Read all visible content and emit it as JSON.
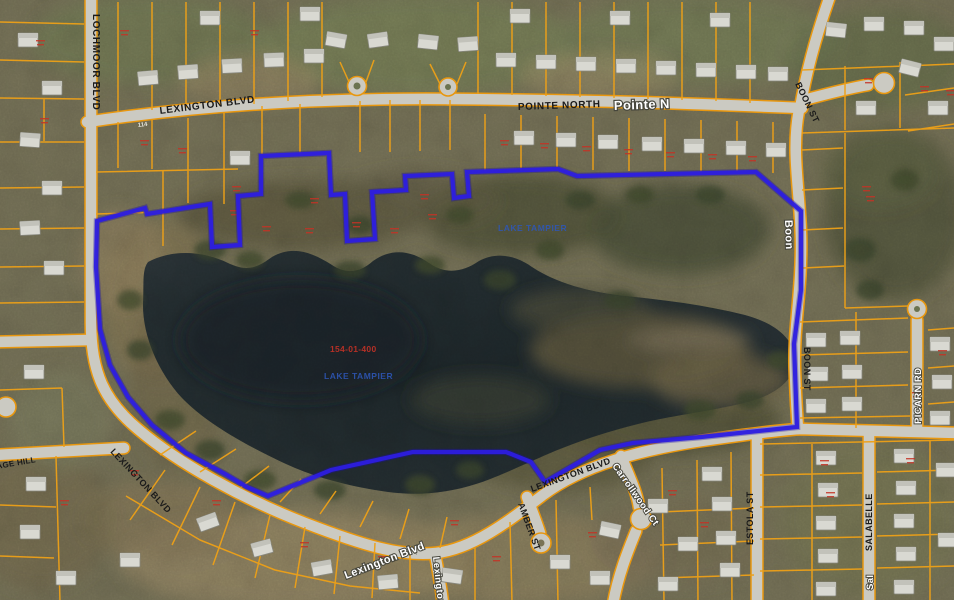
{
  "map": {
    "description": "Aerial photo parcel viewer with lake parcel selected in blue",
    "streets": {
      "lochmoor": "LOCHMOOR BLVD",
      "lexington_top": "LEXINGTON BLVD",
      "pointe_north": "POINTE NORTH",
      "pointe_n_road": "Pointe N",
      "boon_top": "BOON ST",
      "boon_road": "Boon",
      "boon_mid": "BOON ST",
      "picarn_road": "PICARN RD",
      "lexington_sw": "LEXINGTON BLVD",
      "age_hill": "AGE HILL",
      "lexington_road": "Lexington Blvd",
      "lexington_road_vert": "Lexington",
      "amber": "AMBER ST",
      "carrollwood_road": "Carrollwood Ct",
      "lexington_se": "LEXINGTON BLVD",
      "estola": "ESTOLA ST",
      "salabelle": "SALABELLE",
      "salabelle_road": "Sal"
    },
    "road_marker": "114",
    "water": {
      "label_upper": "LAKE TAMPIER",
      "label_lower": "LAKE TAMPIER"
    },
    "selected_parcel": {
      "id_label": "154-01-400"
    },
    "colors": {
      "parcel_line": "#EDA017",
      "selection_outline": "#2D1EE0",
      "road": "#CBCAC2",
      "water": "#20292C",
      "annotation_red": "#C33226",
      "water_label_blue": "#2E57B8"
    }
  }
}
